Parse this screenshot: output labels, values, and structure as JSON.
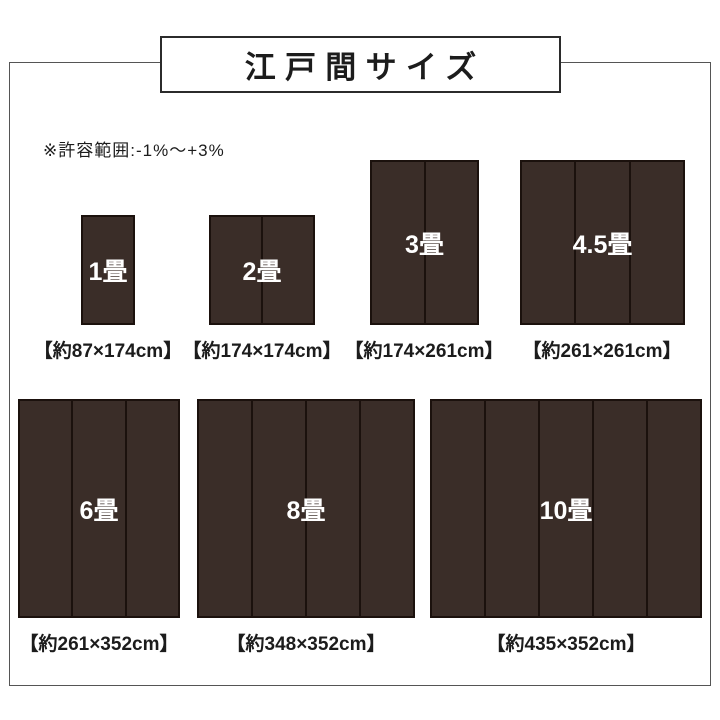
{
  "title": "江戸間サイズ",
  "note": "※許容範囲:-1%〜+3%",
  "colors": {
    "mat_brown": "#3a2d28",
    "mat_divider": "#1b110d",
    "frame_gray": "#555555",
    "text_black": "#1c1c1c",
    "label_white": "#ffffff"
  },
  "mats": [
    {
      "label": "1畳",
      "dims": "【約87×174cm】",
      "width_cm": 87,
      "height_cm": 174,
      "panels": 1
    },
    {
      "label": "2畳",
      "dims": "【約174×174cm】",
      "width_cm": 174,
      "height_cm": 174,
      "panels": 2
    },
    {
      "label": "3畳",
      "dims": "【約174×261cm】",
      "width_cm": 174,
      "height_cm": 261,
      "panels": 2
    },
    {
      "label": "4.5畳",
      "dims": "【約261×261cm】",
      "width_cm": 261,
      "height_cm": 261,
      "panels": 3
    },
    {
      "label": "6畳",
      "dims": "【約261×352cm】",
      "width_cm": 261,
      "height_cm": 352,
      "panels": 3
    },
    {
      "label": "8畳",
      "dims": "【約348×352cm】",
      "width_cm": 348,
      "height_cm": 352,
      "panels": 4
    },
    {
      "label": "10畳",
      "dims": "【約435×352cm】",
      "width_cm": 435,
      "height_cm": 352,
      "panels": 5
    }
  ]
}
